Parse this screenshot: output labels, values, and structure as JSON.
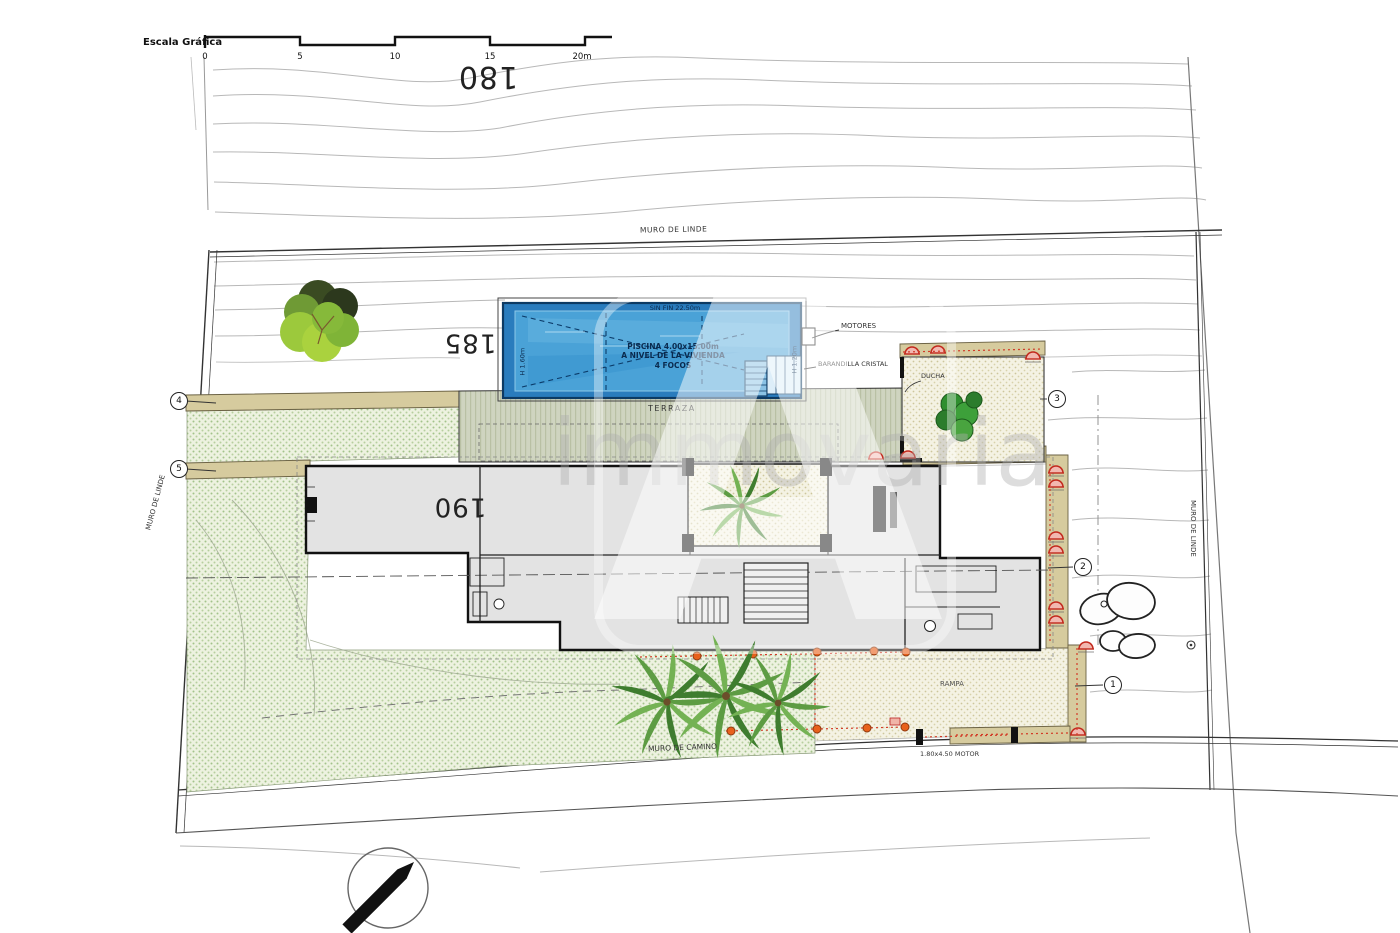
{
  "meta": {
    "type": "architectural-site-plan"
  },
  "scale_bar": {
    "label": "Escala Gráfica",
    "ticks": [
      "0",
      "5",
      "10",
      "15",
      "20m"
    ]
  },
  "contour_labels": [
    "180",
    "185",
    "190"
  ],
  "walls": {
    "top": "MURO DE LINDE",
    "left": "MURO DE LINDE",
    "right": "MURO DE LINDE",
    "bottom": "MURO DE CAMINO"
  },
  "pool": {
    "edge": "SIN FIN 22.50m",
    "title": "PISCINA 4.00x15.00m",
    "subtitle": "A NIVEL DE LA VIVIENDA",
    "lights": "4 FOCOS",
    "depth_left": "H 1.60m",
    "depth_right": "H 1.20m",
    "motors_label": "MOTORES",
    "railing_label": "BARANDILLA CRISTAL"
  },
  "site": {
    "terrace": "TERRAZA",
    "shower": "DUCHA",
    "ramp": "RAMPA",
    "gate": "1.80x4.50 MOTOR"
  },
  "markers": [
    "4",
    "5",
    "3",
    "2",
    "1"
  ],
  "watermark": {
    "text": "immovaria",
    "logo_letter": "A"
  },
  "colors": {
    "pool_deep": "#2a7cbd",
    "pool_mid": "#4aa2d7",
    "terrace_band": "#cfd4c0",
    "garden_green": "#edf2e0",
    "garden_dot": "#a3c38b",
    "path_tan": "#d6cb9e",
    "accent_red": "#d23b27",
    "dot_orange": "#e8611c"
  }
}
